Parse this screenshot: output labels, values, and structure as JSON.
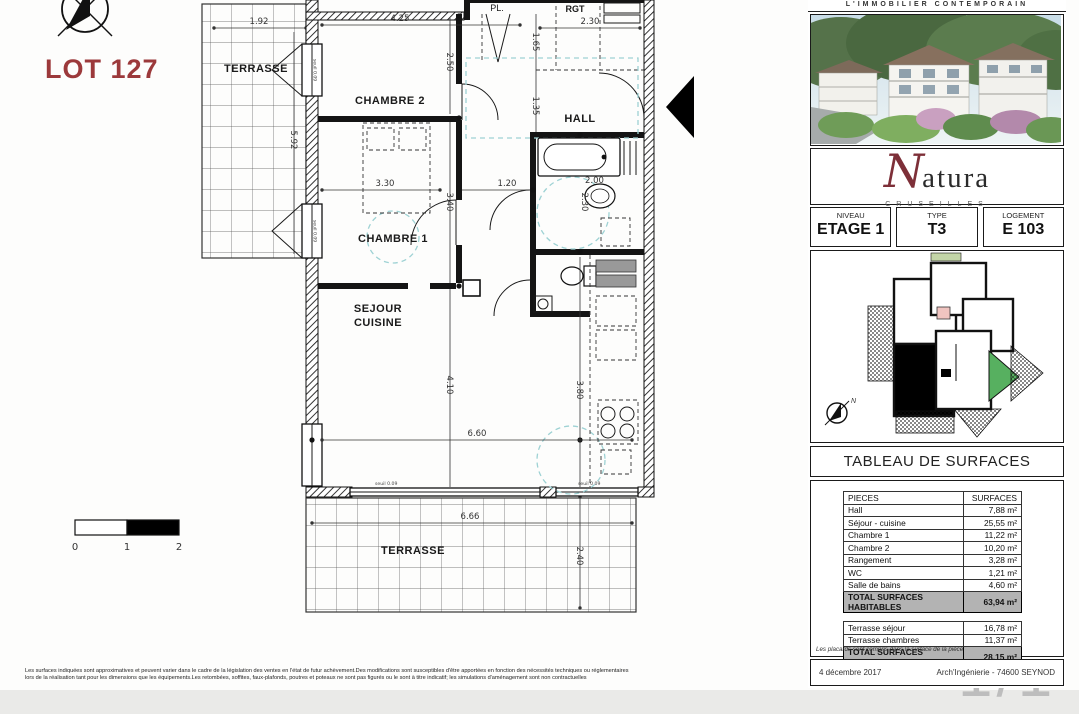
{
  "page": {
    "lot_label": "LOT 127",
    "disclaimer_line1": "Les surfaces indiquées sont approximatives et peuvent varier dans le cadre de la législation des ventes en l'état de futur achèvement.Des modifications sont susceptibles d'être apportées en fonction des nécessités techniques ou réglementaires",
    "disclaimer_line2": "lors de la réalisation tant pour les dimensions que les équipements.Les retombées, soffites, faux-plafonds, poutres et poteaux ne sont pas figurés ou le sont à titre indicatif; les simulations d'aménagement sont non contractuelles",
    "page_number": "1/1"
  },
  "plan": {
    "scale": {
      "s0": "0",
      "s1": "1",
      "s2": "2"
    },
    "rooms": {
      "terrasse_left": "TERRASSE",
      "chambre2": "CHAMBRE 2",
      "chambre1": "CHAMBRE 1",
      "sejour": "SEJOUR",
      "cuisine": "CUISINE",
      "hall": "HALL",
      "rgt": "RGT",
      "pl": "PL.",
      "terrasse_bottom": "TERRASSE"
    },
    "dims": {
      "terrace_width": "1.92",
      "terrace_height": "5.92",
      "chambre2_width": "4.25",
      "chambre2_height": "2.50",
      "rgt_width": "2.30",
      "hall_d1": "1.65",
      "hall_d2": "1.35",
      "chambre1_width": "3.30",
      "chambre1_height": "3.40",
      "hall_width": "1.20",
      "bath_d1": "2.00",
      "bath_d2": "2.30",
      "sejour_height": "4.10",
      "sejour_width": "6.60",
      "cuisine_height": "3.80",
      "terrasse_bottom_width": "6.66",
      "terrasse_bottom_height": "2.40",
      "seuil_1": "seuil 0.09",
      "seuil_2": "seuil 0.09",
      "seuil_3": "seuil 0.09",
      "seuil_4": "seuil 0.09"
    }
  },
  "panel": {
    "tagline": "L'IMMOBILIER CONTEMPORAIN",
    "brand": {
      "initial": "N",
      "rest": "atura",
      "city": "CRUSEILLES"
    },
    "info": [
      {
        "label": "NIVEAU",
        "value": "ETAGE 1"
      },
      {
        "label": "TYPE",
        "value": "T3"
      },
      {
        "label": "LOGEMENT",
        "value": "E 103"
      }
    ],
    "keyplan_north": "N",
    "table_title": "TABLEAU DE SURFACES",
    "table": {
      "headers": [
        "PIECES",
        "SURFACES"
      ],
      "rows": [
        {
          "name": "Hall",
          "value": "7,88 m²"
        },
        {
          "name": "Séjour - cuisine",
          "value": "25,55 m²"
        },
        {
          "name": "Chambre 1",
          "value": "11,22 m²"
        },
        {
          "name": "Chambre 2",
          "value": "10,20 m²"
        },
        {
          "name": "Rangement",
          "value": "3,28 m²"
        },
        {
          "name": "WC",
          "value": "1,21 m²"
        },
        {
          "name": "Salle de bains",
          "value": "4,60 m²"
        }
      ],
      "total_habitables": {
        "label": "TOTAL SURFACES HABITABLES",
        "value": "63,94 m²"
      },
      "annex_rows": [
        {
          "name": "Terrasse séjour",
          "value": "16,78 m²"
        },
        {
          "name": "Terrasse chambres",
          "value": "11,37 m²"
        }
      ],
      "total_annexes": {
        "label": "TOTAL SURFACES ANNEXES",
        "value": "28,15 m²"
      },
      "note": "Les placards sont compris dans la surface de la pièce"
    },
    "footer": {
      "date": "4 décembre 2017",
      "firm": "Arch'Ingénierie - 74600 SEYNOD"
    }
  },
  "colors": {
    "accent_red": "#9c393b",
    "brand_red": "#7d2f38",
    "total_row_bg": "#b3b3b3",
    "plan_cyan": "#9ed2d4",
    "key_green": "#57b060",
    "key_pink": "#f0c4c0"
  }
}
